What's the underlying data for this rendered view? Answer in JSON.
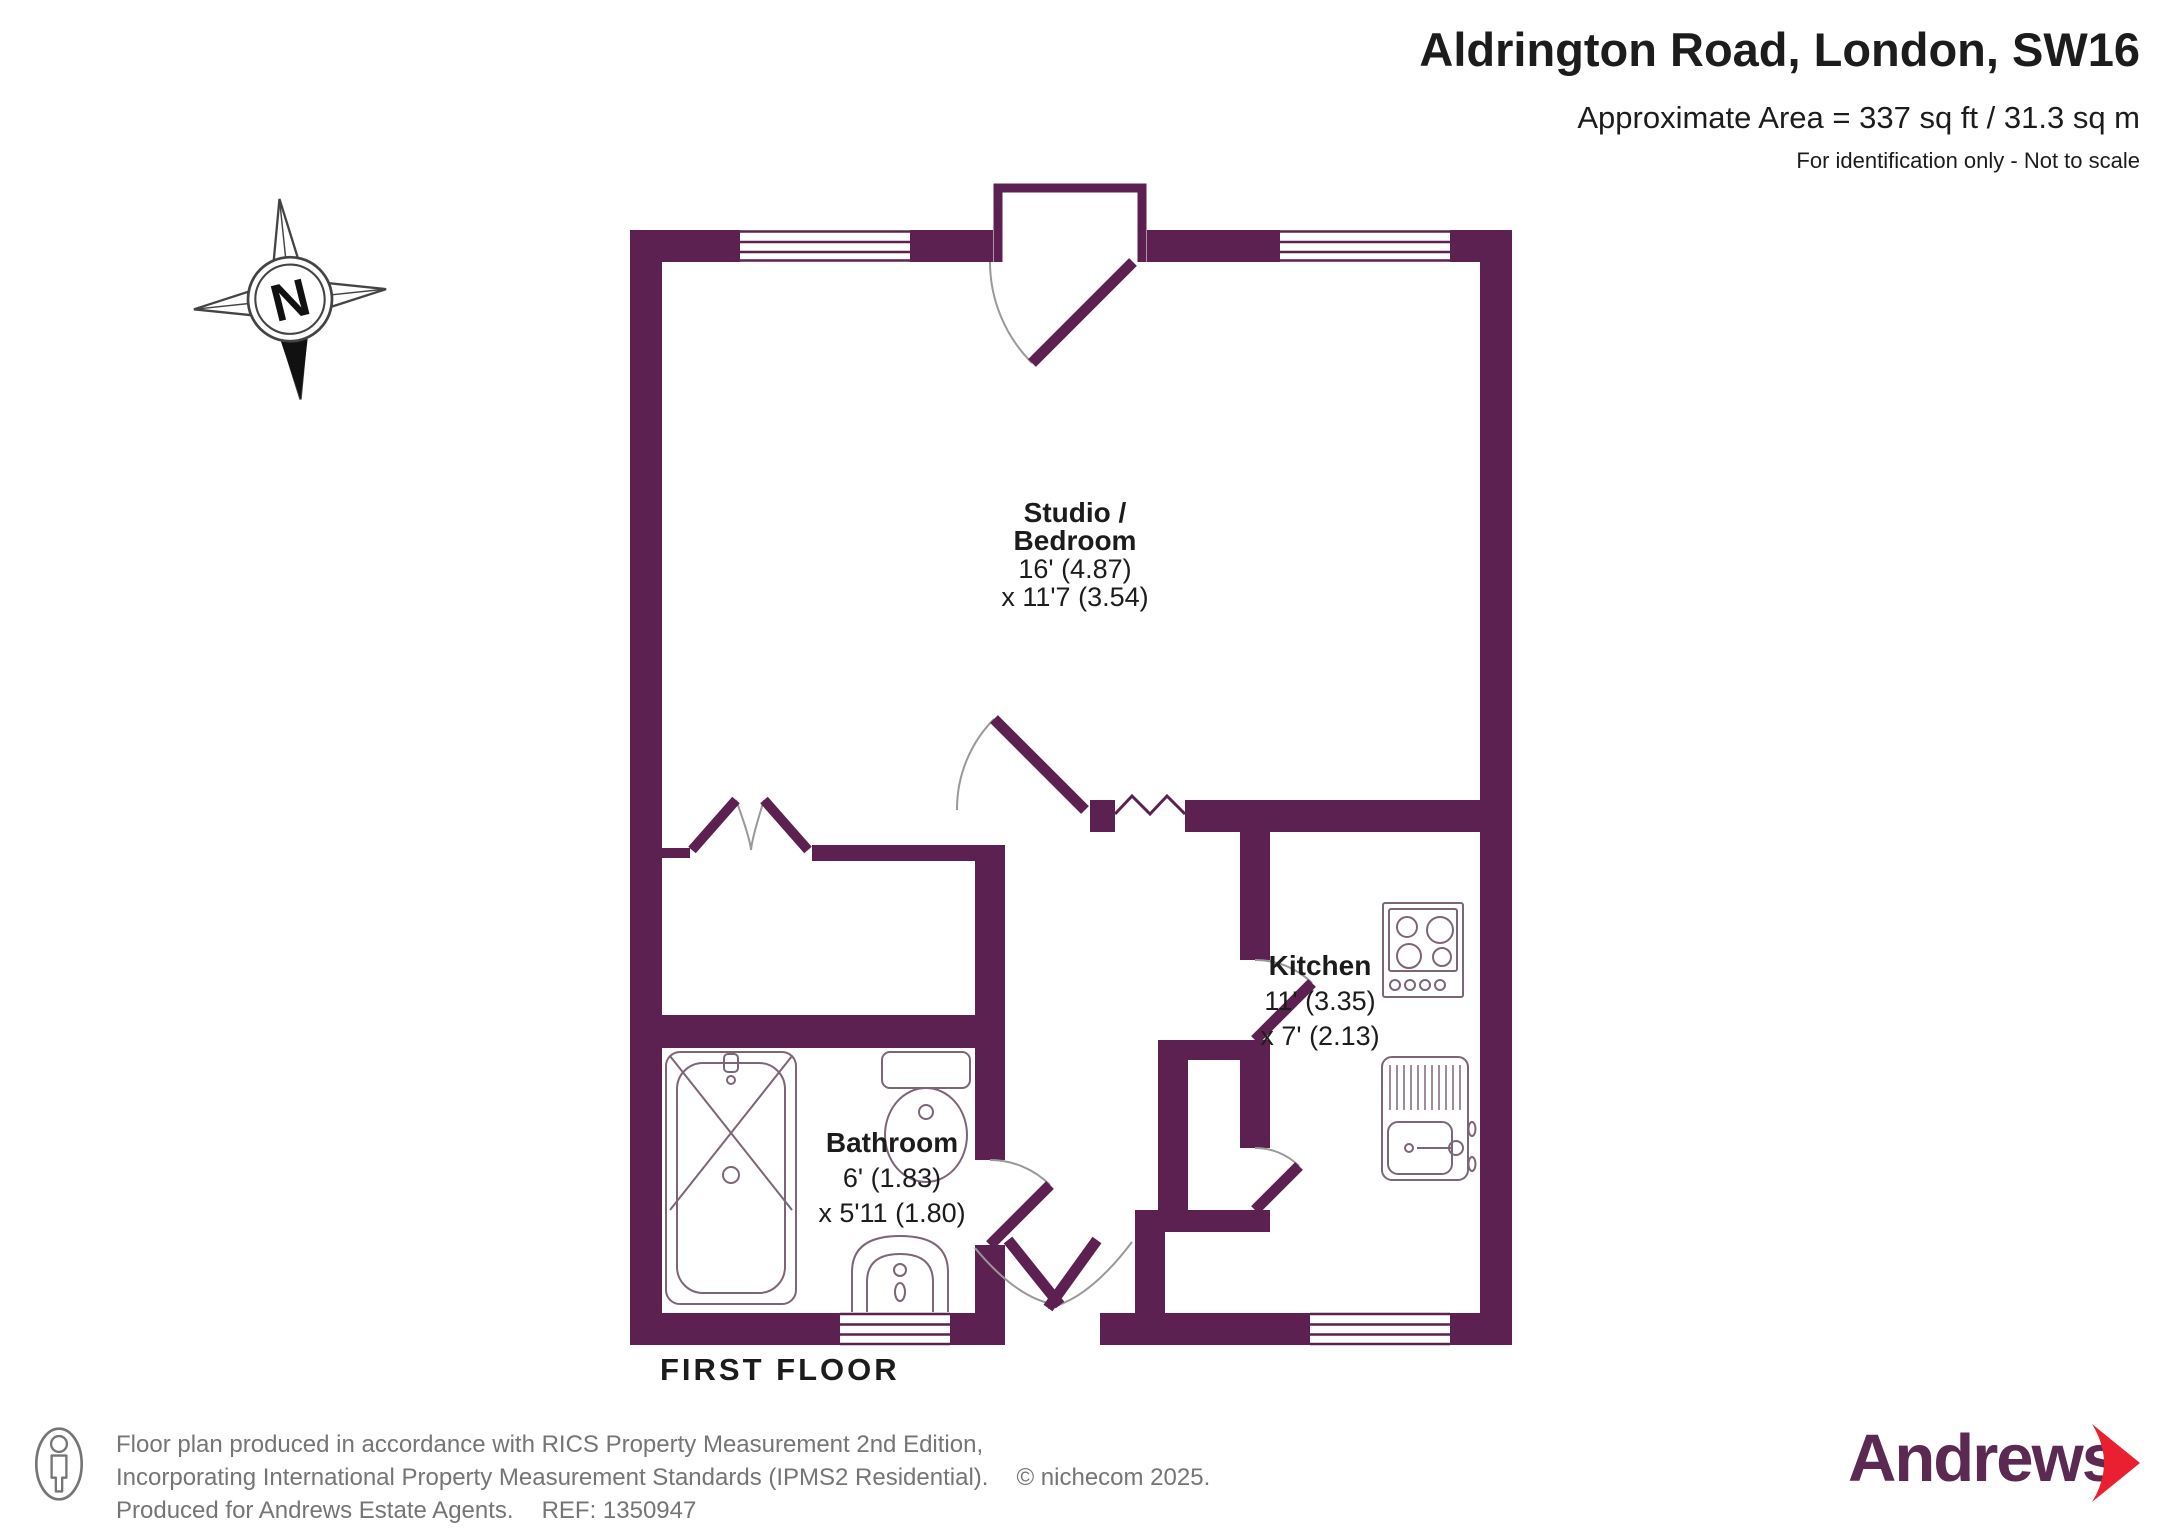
{
  "header": {
    "title": "Aldrington Road, London, SW16",
    "area": "Approximate Area = 337 sq ft / 31.3 sq m",
    "disclaimer": "For identification only - Not to scale"
  },
  "compass": {
    "north_label": "N"
  },
  "plan": {
    "floor_label": "FIRST FLOOR",
    "rooms": {
      "studio": {
        "name_line1": "Studio /",
        "name_line2": "Bedroom",
        "dim_line1": "16' (4.87)",
        "dim_line2": "x 11'7 (3.54)"
      },
      "kitchen": {
        "name": "Kitchen",
        "dim_line1": "11' (3.35)",
        "dim_line2": "x 7' (2.13)"
      },
      "bathroom": {
        "name": "Bathroom",
        "dim_line1": "6' (1.83)",
        "dim_line2": "x 5'11 (1.80)"
      }
    }
  },
  "footer": {
    "line1": "Floor plan produced in accordance with RICS Property Measurement 2nd Edition,",
    "line2": "Incorporating International Property Measurement Standards (IPMS2 Residential).",
    "copyright": "© nichecom 2025.",
    "line3": "Produced for Andrews Estate Agents.",
    "ref": "REF: 1350947"
  },
  "brand": {
    "name": "Andrews"
  },
  "colors": {
    "wall": "#5c2150",
    "fixture_outline": "#7d6578",
    "door_arc": "#999999",
    "brand_purple": "#5a2a52",
    "brand_red": "#ea1f2f",
    "text": "#1c1c1c",
    "footer_text": "#757575"
  }
}
